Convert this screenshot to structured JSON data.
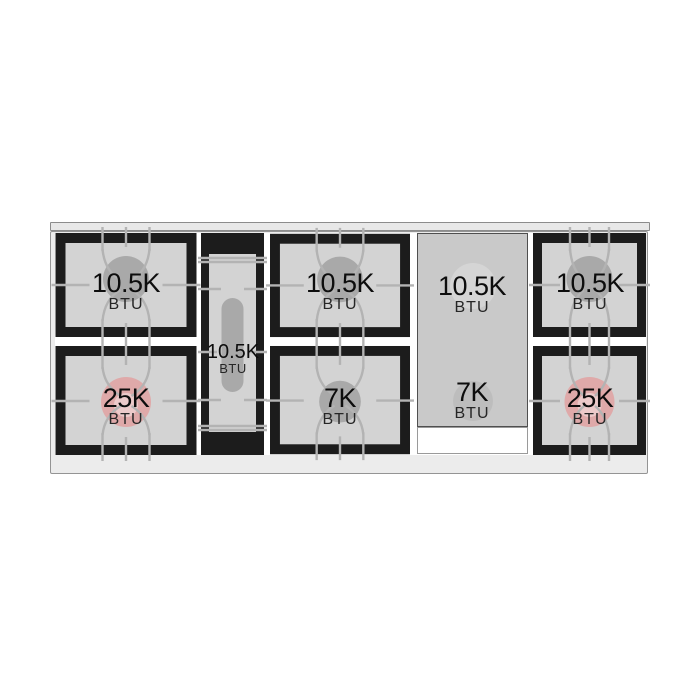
{
  "colors": {
    "flame_gray": "#a9a9a9",
    "flame_pink": "#dfa9a9",
    "flame_pink_ring": "#eccaca",
    "grate_black": "#1c1c1c",
    "grate_line": "#b3b3b3",
    "burner_surface": "#d3d3d3",
    "griddle_surface": "#c9c9c9",
    "frame_surface": "#ececec"
  },
  "cooktop": {
    "sections": [
      {
        "id": "left-double",
        "type": "double-burner",
        "burners": [
          {
            "value": "10.5K",
            "unit": "BTU",
            "flame": "gray"
          },
          {
            "value": "25K",
            "unit": "BTU",
            "flame": "pink"
          }
        ]
      },
      {
        "id": "center-oval",
        "type": "oval-burner",
        "burners": [
          {
            "value": "10.5K",
            "unit": "BTU",
            "flame": "gray"
          }
        ]
      },
      {
        "id": "mid-double",
        "type": "double-burner",
        "burners": [
          {
            "value": "10.5K",
            "unit": "BTU",
            "flame": "gray"
          },
          {
            "value": "7K",
            "unit": "BTU",
            "flame": "gray"
          }
        ]
      },
      {
        "id": "griddle",
        "type": "griddle",
        "burners": [
          {
            "value": "10.5K",
            "unit": "BTU",
            "flame": "gray"
          },
          {
            "value": "7K",
            "unit": "BTU",
            "flame": "gray"
          }
        ]
      },
      {
        "id": "right-double",
        "type": "double-burner",
        "burners": [
          {
            "value": "10.5K",
            "unit": "BTU",
            "flame": "gray"
          },
          {
            "value": "25K",
            "unit": "BTU",
            "flame": "pink"
          }
        ]
      }
    ]
  }
}
